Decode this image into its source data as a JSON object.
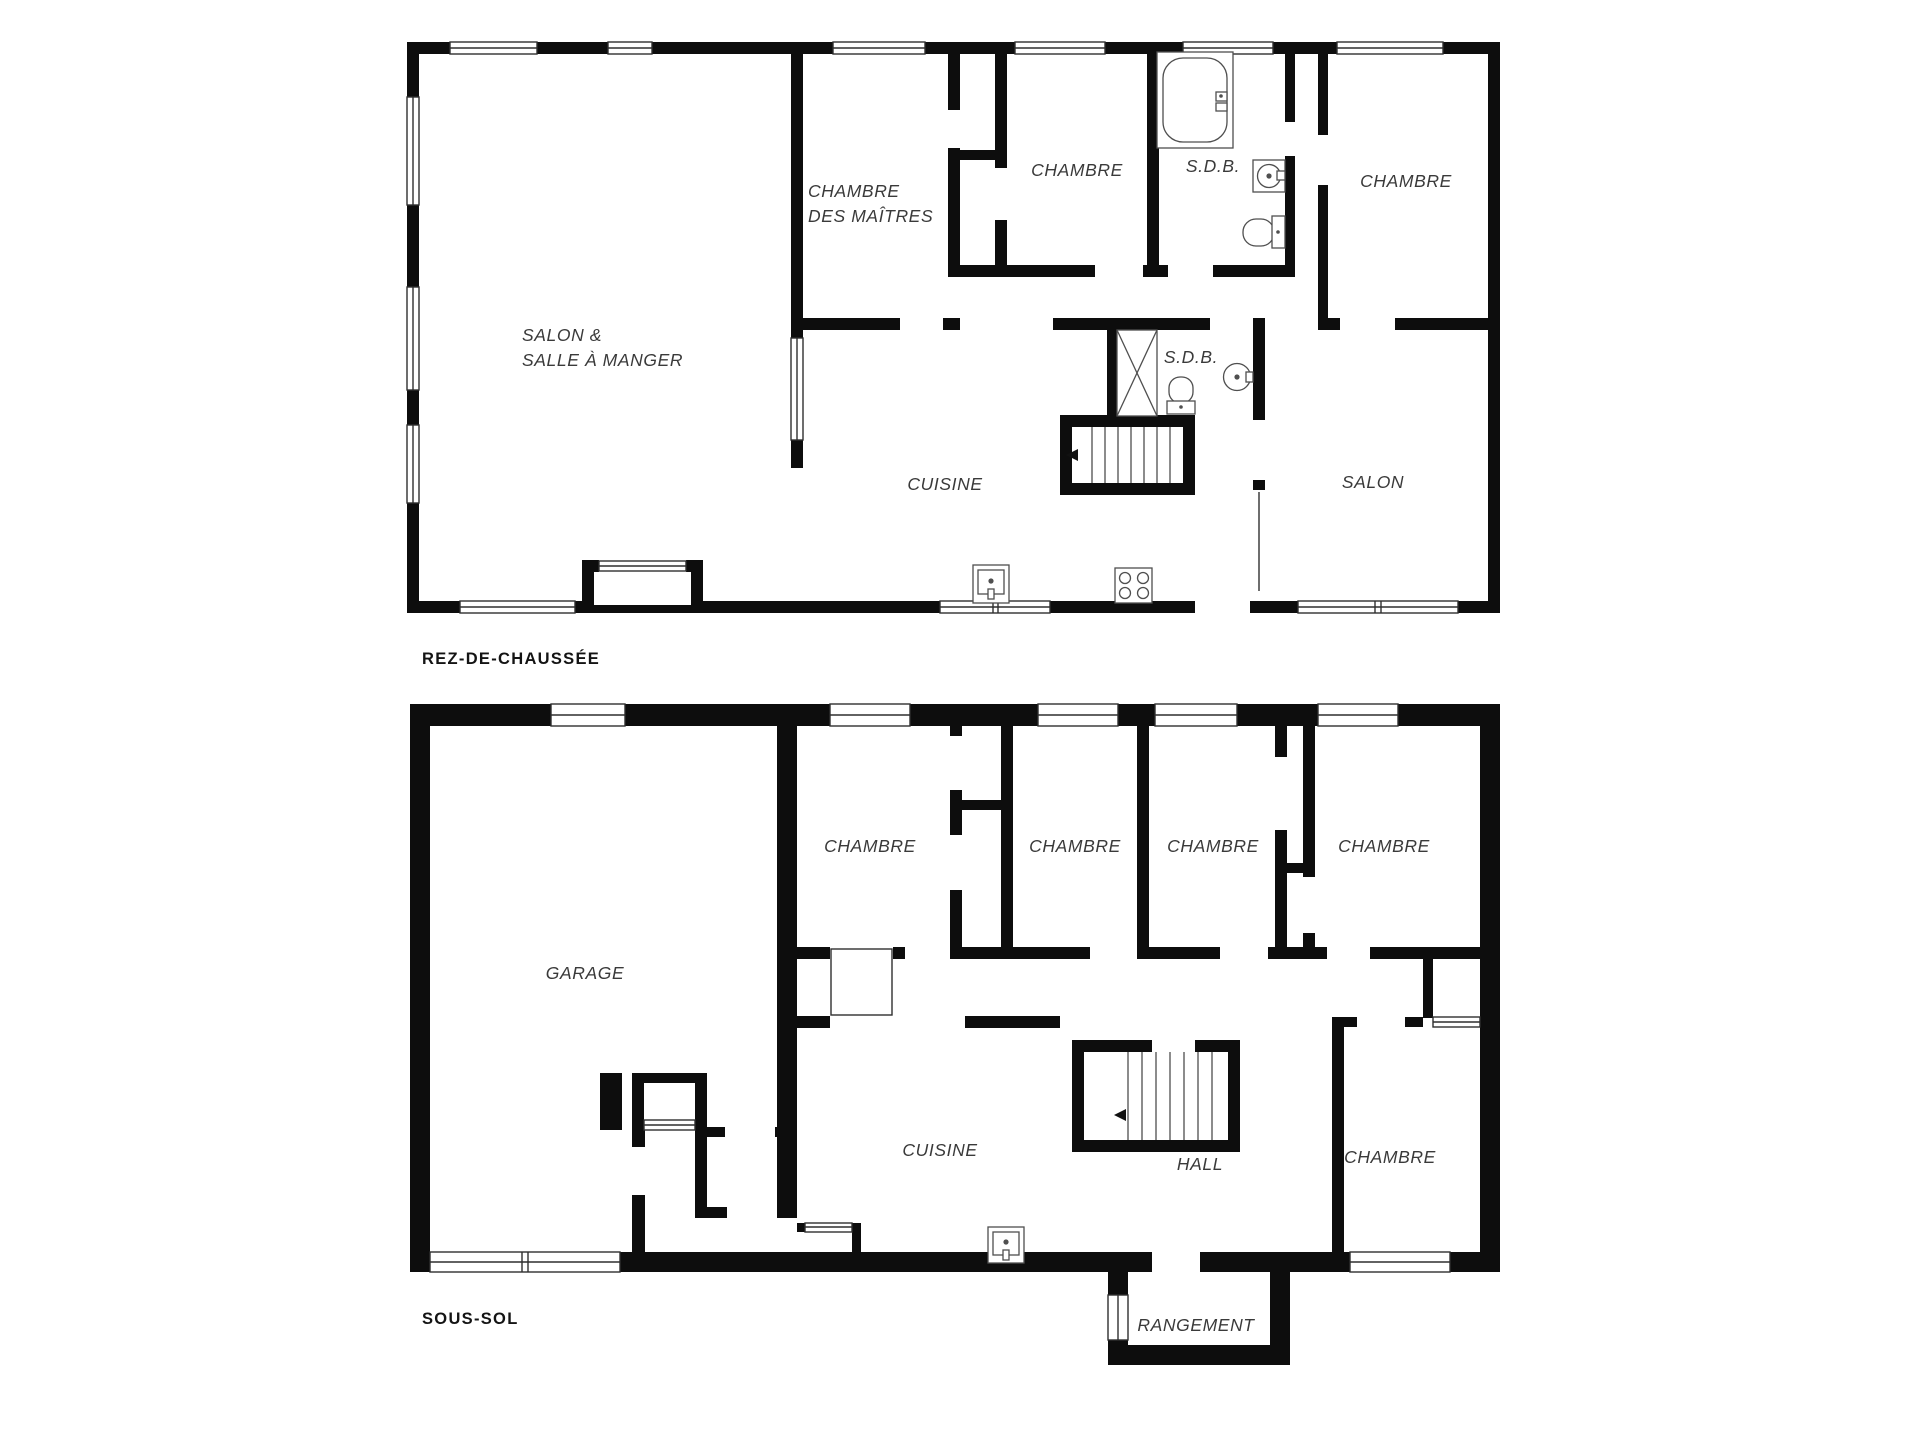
{
  "colors": {
    "background": "#ffffff",
    "wall": "#0d0d0d",
    "fixture_stroke": "#4f4f4f",
    "room_label": "#3a3a3a",
    "floor_title": "#141414"
  },
  "floors": [
    {
      "id": "rez-de-chaussee",
      "title": "REZ-DE-CHAUSSÉE",
      "rooms": [
        {
          "name": "salon-salle-a-manger",
          "label_lines": [
            "SALON &",
            "SALLE À MANGER"
          ]
        },
        {
          "name": "chambre-des-maitres",
          "label_lines": [
            "CHAMBRE",
            "DES MAÎTRES"
          ]
        },
        {
          "name": "chambre-haut-centre",
          "label": "CHAMBRE"
        },
        {
          "name": "salle-de-bain-haut",
          "label": "S.D.B."
        },
        {
          "name": "chambre-haut-droite",
          "label": "CHAMBRE"
        },
        {
          "name": "cuisine",
          "label": "CUISINE"
        },
        {
          "name": "salle-de-bain-centre",
          "label": "S.D.B."
        },
        {
          "name": "salon",
          "label": "SALON"
        }
      ],
      "fixtures": [
        "bathtub-icon",
        "sink-round-icon",
        "toilet-icon",
        "shower-icon",
        "toilet-icon",
        "sink-round-icon",
        "kitchen-sink-icon",
        "stove-icon",
        "stairs-down-icon",
        "fireplace-icon"
      ]
    },
    {
      "id": "sous-sol",
      "title": "SOUS-SOL",
      "rooms": [
        {
          "name": "garage",
          "label": "GARAGE"
        },
        {
          "name": "chambre-1",
          "label": "CHAMBRE"
        },
        {
          "name": "chambre-2",
          "label": "CHAMBRE"
        },
        {
          "name": "chambre-3",
          "label": "CHAMBRE"
        },
        {
          "name": "chambre-4",
          "label": "CHAMBRE"
        },
        {
          "name": "cuisine",
          "label": "CUISINE"
        },
        {
          "name": "hall",
          "label": "HALL"
        },
        {
          "name": "chambre-5",
          "label": "CHAMBRE"
        },
        {
          "name": "rangement",
          "label": "RANGEMENT"
        }
      ],
      "fixtures": [
        "stairs-down-icon",
        "kitchen-sink-icon",
        "garage-door-icon"
      ]
    }
  ]
}
